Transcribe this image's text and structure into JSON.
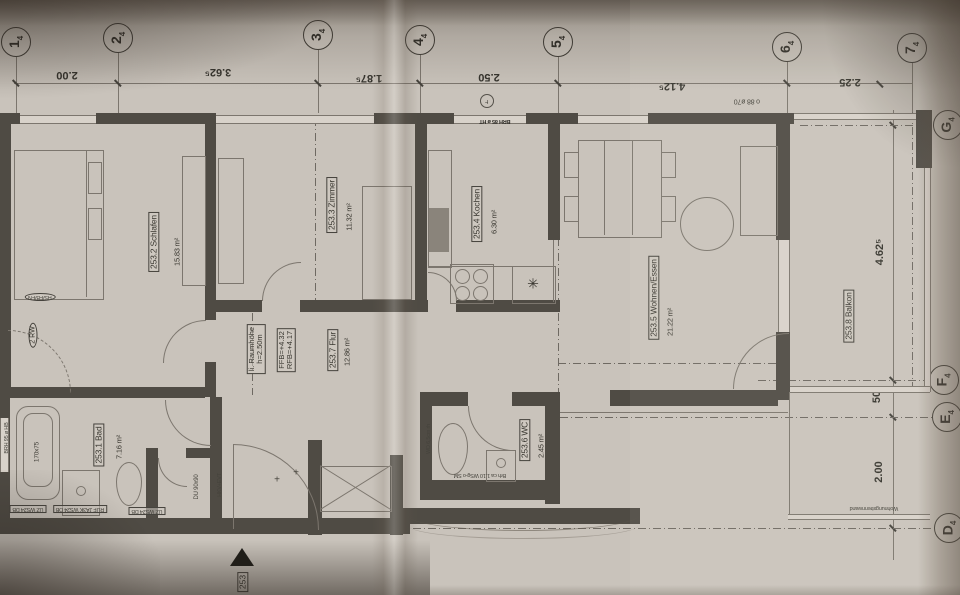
{
  "sheet": {
    "apartment_number": "253"
  },
  "colors": {
    "paper": "#c9c3bb",
    "ink": "#38362f",
    "wall": "#4f4b44",
    "line": "#7c766e"
  },
  "axes": {
    "top": [
      {
        "n": "1",
        "s": "4"
      },
      {
        "n": "2",
        "s": "4"
      },
      {
        "n": "3",
        "s": "4"
      },
      {
        "n": "4",
        "s": "4"
      },
      {
        "n": "5",
        "s": "4"
      },
      {
        "n": "6",
        "s": "4"
      },
      {
        "n": "7",
        "s": "4"
      }
    ],
    "right": [
      {
        "n": "G",
        "s": "4"
      },
      {
        "n": "F",
        "s": "4"
      },
      {
        "n": "E",
        "s": "4"
      },
      {
        "n": "D",
        "s": "4"
      }
    ]
  },
  "dims": {
    "top": [
      "2.00",
      "3.62⁵",
      "1.87⁵",
      "2.50",
      "4.12⁵",
      "2.25"
    ],
    "right": [
      "4.62⁵",
      "50",
      "2.00"
    ]
  },
  "rooms": {
    "bad": {
      "label": "253.1 Bad",
      "area": "7.16 m²"
    },
    "schlafen": {
      "label": "253.2 Schlafen",
      "area": "15.83 m²"
    },
    "zimmer": {
      "label": "253.3 Zimmer",
      "area": "11.32 m²"
    },
    "kochen": {
      "label": "253.4 Kochen",
      "area": "6.30 m²"
    },
    "wohnen": {
      "label": "253.5 Wohnen/Essen",
      "area": "21.22 m²"
    },
    "wc": {
      "label": "253.6 WC",
      "area": "2.45 m²"
    },
    "flur": {
      "label": "253.7 Flur",
      "area": "12.86 m²"
    },
    "balkon": {
      "label": "253.8 Balkon"
    }
  },
  "annotations": {
    "raumhoehe1": "li. Raumhöhe",
    "raumhoehe2": "h=2.50m",
    "ffb": "FFB=+4.32",
    "rfb": "RFB=+4.17",
    "rw": "2 RW",
    "hs": "HS/FB/FN",
    "tub": "170x75",
    "shower": "DU 90x90",
    "top_note": "o 88 ø70",
    "brh": "BRH 85 ø HT",
    "f": "F",
    "uz1": "UZ WS24 DB",
    "uz2": "RUF JA3K WS24 DB",
    "uz3": "UZ WS24 DB",
    "wd": "WD 6,5cm rh",
    "wc_note": "Brh ca 1.10 WSg-o SM",
    "trennwand": "Wohnungstrennwand",
    "hkv": "HKV+EVT",
    "brh_left": "BRH 95 ø HB",
    "apt": "253",
    "cross": "+",
    "star": "✳"
  }
}
